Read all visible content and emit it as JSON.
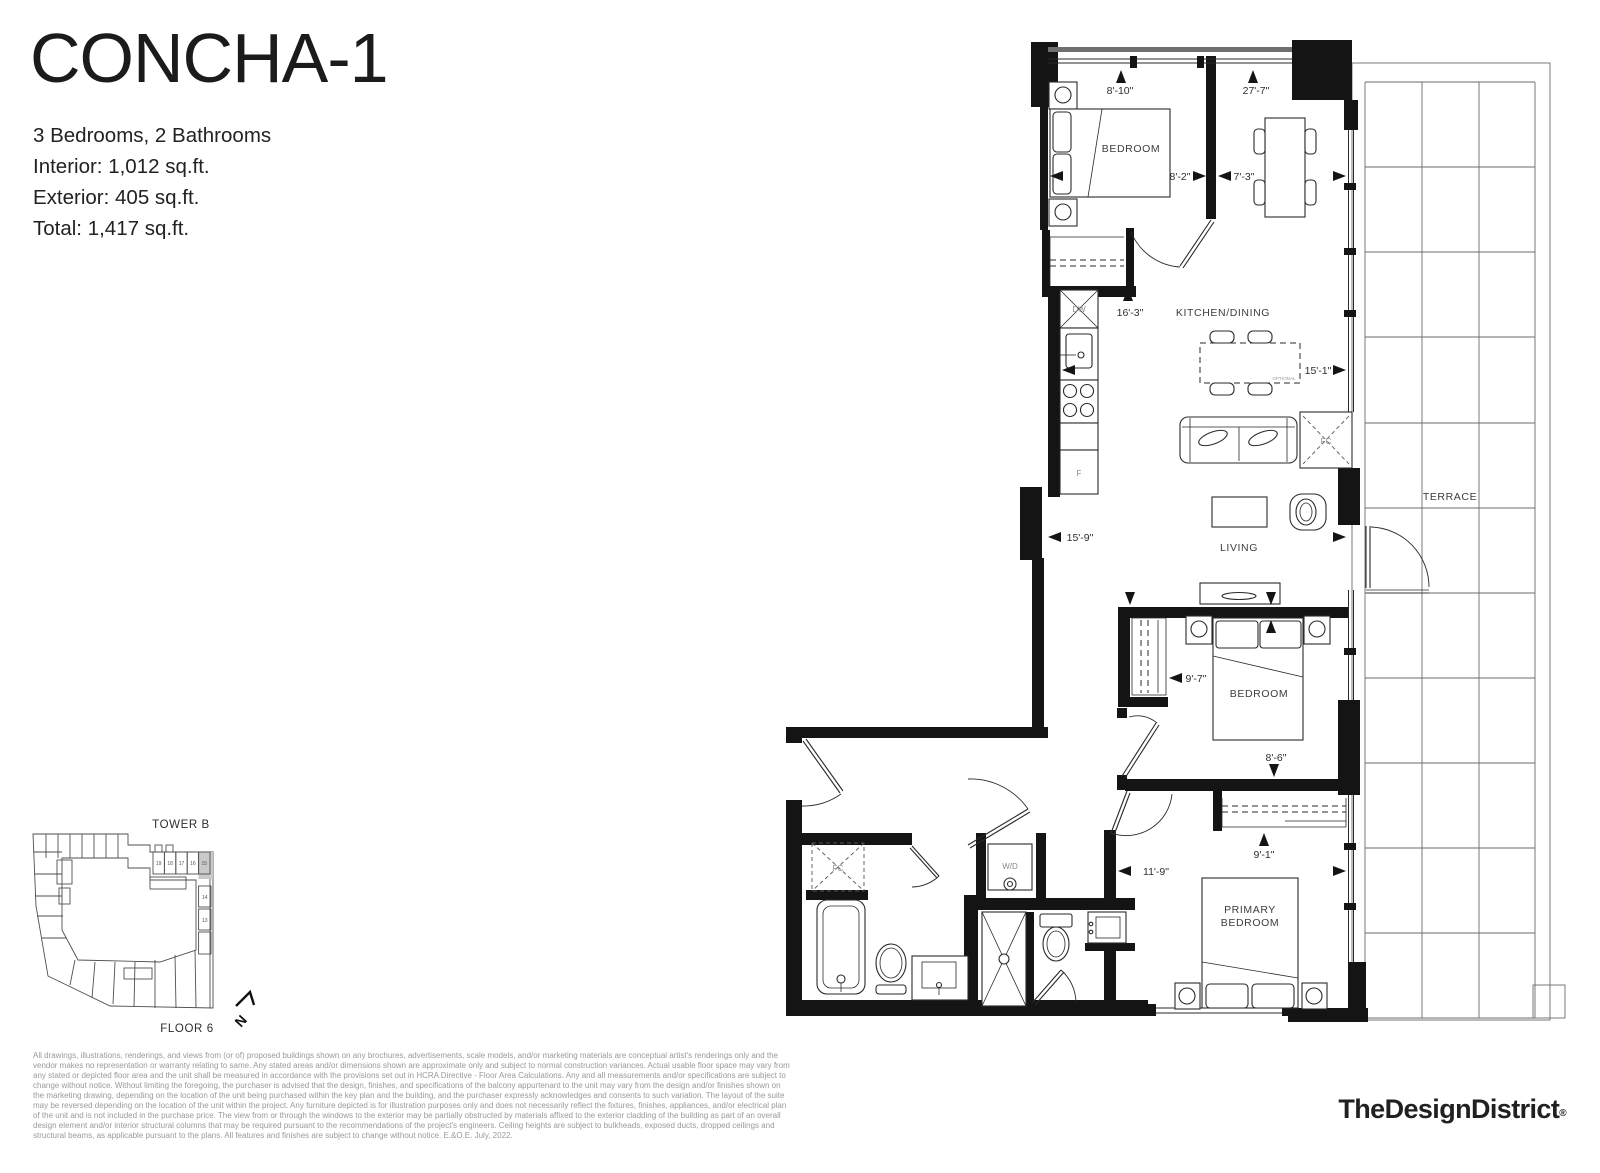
{
  "header": {
    "title": "CONCHA-1",
    "specs": [
      "3 Bedrooms, 2 Bathrooms",
      "Interior: 1,012 sq.ft.",
      "Exterior: 405 sq.ft.",
      "Total: 1,417 sq.ft."
    ]
  },
  "plan": {
    "rooms": {
      "bedroom_top": "BEDROOM",
      "kitchen_dining": "KITCHEN/DINING",
      "living": "LIVING",
      "bedroom_mid": "BEDROOM",
      "primary_line1": "PRIMARY",
      "primary_line2": "BEDROOM",
      "terrace": "TERRACE"
    },
    "fixtures": {
      "dishwasher": "DW",
      "fridge": "F",
      "fc_living": "FC",
      "fc_hall": "FC",
      "washer_dryer": "W/D",
      "optional": "OPTIONAL"
    },
    "dimensions": {
      "bedroom_top_w": "8'-10\"",
      "overall_len": "27'-7\"",
      "bedroom_top_d": "8'-2\"",
      "dining_w": "7'-3\"",
      "kitchen_len": "16'-3\"",
      "kitchen_dining_w": "15'-1\"",
      "living_w": "15'-9\"",
      "bedroom_mid_w": "9'-7\"",
      "bedroom_mid_d": "8'-6\"",
      "primary_d": "9'-1\"",
      "primary_w": "11'-9\""
    }
  },
  "keyplan": {
    "tower": "TOWER B",
    "floor": "FLOOR 6",
    "north": "N",
    "units": [
      "19",
      "18",
      "17",
      "16",
      "15"
    ],
    "stack": [
      "14",
      "13"
    ],
    "highlighted_unit": "15",
    "highlight_color": "#c9c9c9"
  },
  "footer": {
    "disclaimer": "All drawings, illustrations, renderings, and views from (or of) proposed buildings shown on any brochures, advertisements, scale models, and/or marketing materials are conceptual artist's renderings only and the vendor makes no representation or warranty relating to same. Any stated areas and/or dimensions shown are approximate only and subject to normal construction variances. Actual usable floor space may vary from any stated or depicted floor area and the unit shall be measured in accordance with the provisions set out in HCRA Directive - Floor Area Calculations. Any and all measurements and/or specifications are subject to change without notice. Without limiting the foregoing, the purchaser is advised that the design, finishes, and specifications of the balcony appurtenant to the unit may vary from the design and/or finishes shown on the marketing drawing, depending on the location of the unit being purchased within the key plan and the building, and the purchaser expressly acknowledges and consents to such variation. The layout of the suite may be reversed depending on the location of the unit within the project. Any furniture depicted is for illustration purposes only and does not necessarily reflect the fixtures, finishes, appliances, and/or electrical plan of the unit and is not included in the purchase price. The view from or through the windows to the exterior may be partially obstructed by materials affixed to the exterior cladding of the building as part of an overall design element and/or interior structural columns that may be required pursuant to the recommendations of the project's engineers. Ceiling heights are subject to bulkheads, exposed ducts, dropped ceilings and structural beams, as applicable pursuant to the plans. All features and finishes are subject to change without notice. E.&O.E. July, 2022.",
    "logo": "TheDesignDistrict",
    "registered": "®"
  }
}
